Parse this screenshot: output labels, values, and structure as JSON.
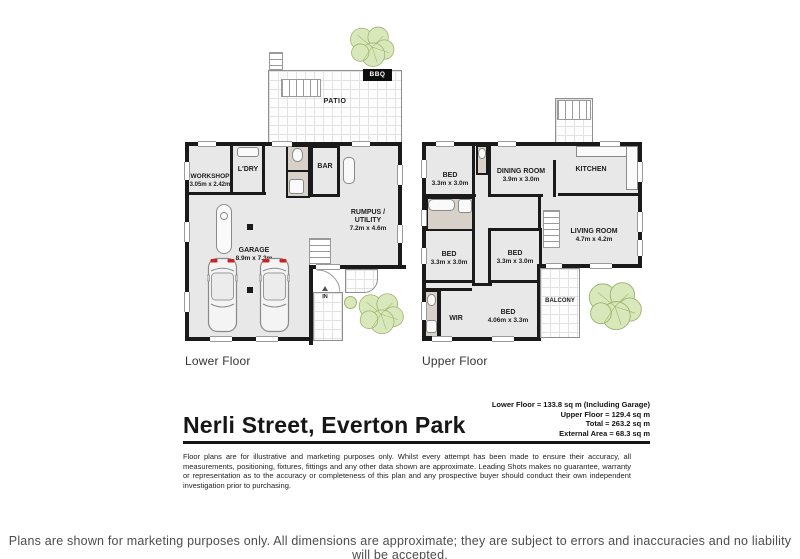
{
  "footer": {
    "text": "Plans are shown for marketing purposes only. All dimensions are approximate; they are subject to errors and inaccuracies and no liability will be accepted."
  },
  "title_block": {
    "address": "Nerli Street, Everton Park",
    "area_lines": "Lower Floor  = 133.8 sq m (Including Garage)\nUpper Floor = 129.4 sq m\nTotal = 263.2 sq m\nExternal Area = 68.3 sq m",
    "disclaimer": "Floor plans are for illustrative and marketing purposes only. Whilst every attempt has been made to ensure their accuracy, all measurements, positioning, fixtures, fittings and any other data shown are approximate. Leading Shots makes no guarantee, warranty or representation as to the accuracy or completeness of this plan and any prospective buyer should conduct their own independent investigation prior to purchasing."
  },
  "lower_floor": {
    "caption": "Lower Floor",
    "rooms": {
      "patio": {
        "name": "PATIO"
      },
      "bbq": {
        "name": "BBQ"
      },
      "workshop": {
        "name": "WORKSHOP",
        "dims": "3.05m x 2.42m"
      },
      "laundry": {
        "name": "L'DRY"
      },
      "bar": {
        "name": "BAR"
      },
      "rumpus": {
        "name": "RUMPUS /\nUTILITY",
        "dims": "7.2m x 4.6m"
      },
      "garage": {
        "name": "GARAGE",
        "dims": "8.9m x 7.3m"
      },
      "entry": {
        "name": "IN"
      }
    }
  },
  "upper_floor": {
    "caption": "Upper Floor",
    "rooms": {
      "bed1": {
        "name": "BED",
        "dims": "3.3m x 3.0m"
      },
      "dining": {
        "name": "DINING ROOM",
        "dims": "3.9m x 3.0m"
      },
      "kitchen": {
        "name": "KITCHEN"
      },
      "bed2": {
        "name": "BED",
        "dims": "3.3m x 3.0m"
      },
      "bed3": {
        "name": "BED",
        "dims": "3.3m x 3.0m"
      },
      "living": {
        "name": "LIVING ROOM",
        "dims": "4.7m x 4.2m"
      },
      "bed4": {
        "name": "BED",
        "dims": "4.06m x 3.3m"
      },
      "wir": {
        "name": "WIR"
      },
      "balcony": {
        "name": "BALCONY"
      }
    }
  },
  "colors": {
    "wall": "#1a1a1a",
    "room_fill": "#e8e8e8",
    "wet_fill": "#d7d1c9",
    "tree_fill": "#d9e8ba",
    "tree_line": "#9db26e",
    "taillight": "#cc2222"
  }
}
